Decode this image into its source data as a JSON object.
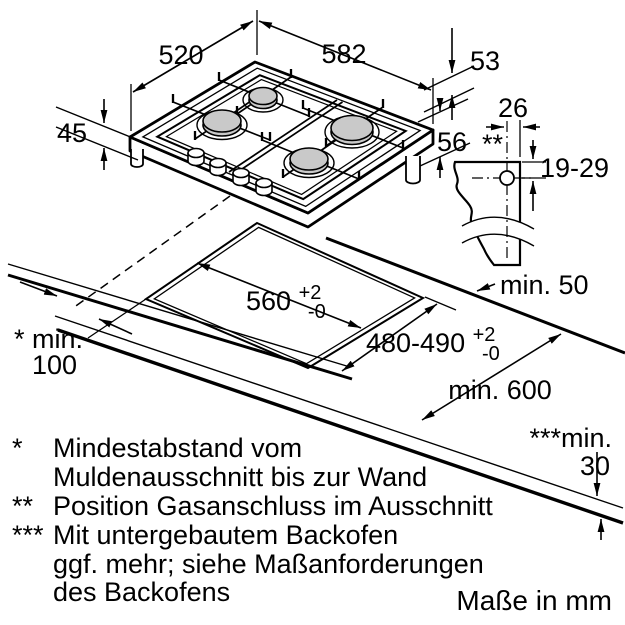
{
  "colors": {
    "line": "#000000",
    "burner_fill": "#c9c9c9",
    "background": "#ffffff"
  },
  "dims": {
    "grid_width": "520",
    "top_width": "582",
    "edge_height": "53",
    "hob_height": "45",
    "body_height": "56",
    "gas_offset_width": "26",
    "gas_connection_mark": "**",
    "gas_depth_range": "19-29",
    "cutout_width": "560",
    "cutout_width_tol_plus": "+2",
    "cutout_width_tol_minus": "-0",
    "cutout_depth": "480-490",
    "cutout_depth_tol_plus": "+2",
    "cutout_depth_tol_minus": "-0",
    "min_back_clearance": "min. 50",
    "min_worktop_depth": "min. 600",
    "min_side_clearance_line1": "* min.",
    "min_side_clearance_line2": "100",
    "min_oven_clearance_line1": "***min.",
    "min_oven_clearance_line2": "30"
  },
  "footnotes": {
    "rows": [
      {
        "marker": "*",
        "text": "Mindestabstand vom"
      },
      {
        "marker": "",
        "text": "Muldenausschnitt bis zur Wand"
      },
      {
        "marker": "**",
        "text": "Position Gasanschluss im Ausschnitt"
      },
      {
        "marker": "***",
        "text": "Mit untergebautem Backofen"
      },
      {
        "marker": "",
        "text": "ggf. mehr; siehe Maßanforderungen"
      },
      {
        "marker": "",
        "text": "des Backofens"
      }
    ]
  },
  "units_note": "Maße in mm"
}
